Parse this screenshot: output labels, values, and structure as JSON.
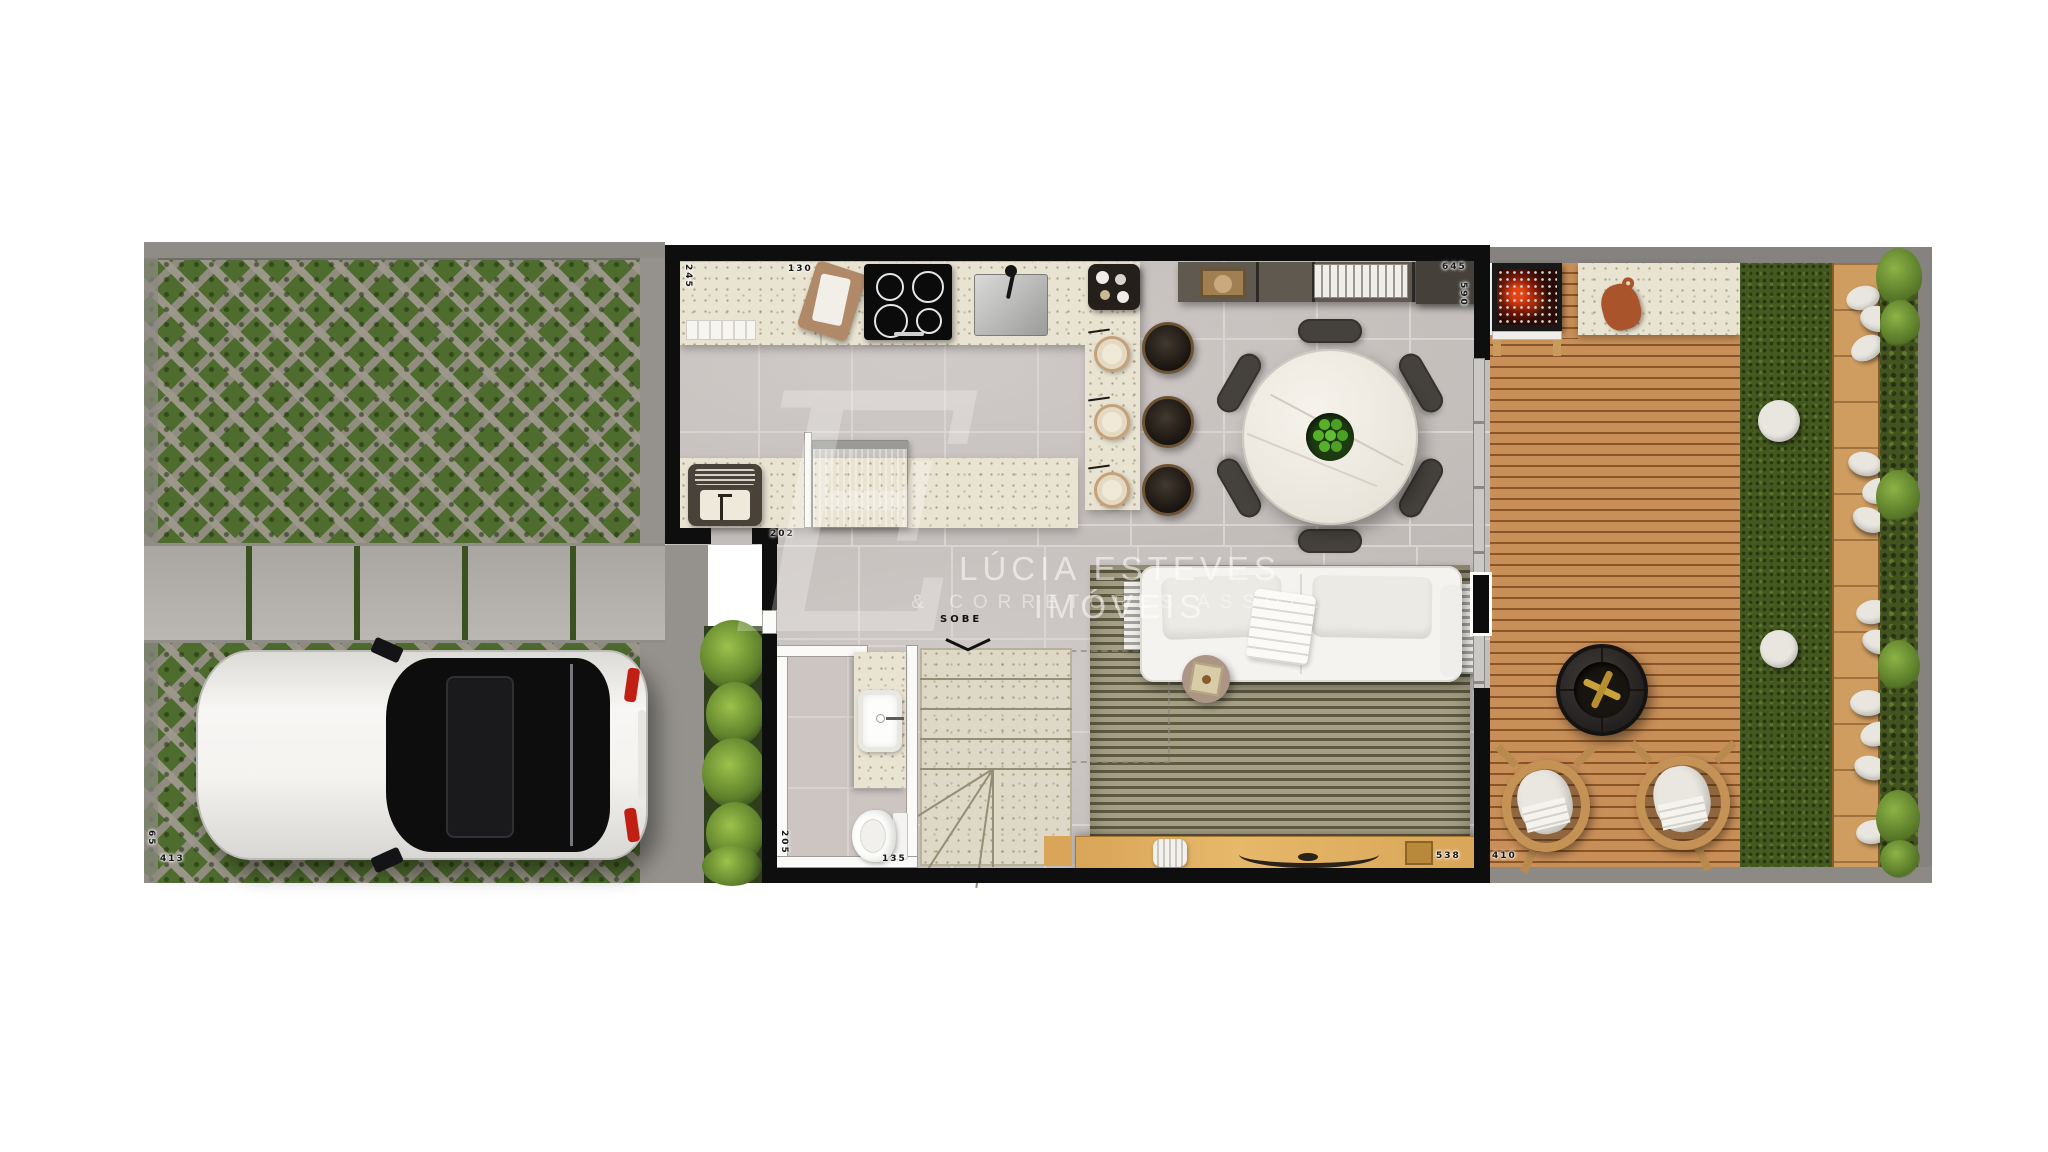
{
  "watermark": {
    "monogram": "E",
    "line1": "LÚCIA ESTEVES IMÓVEIS",
    "line2": "& CORRETORES ASSOC."
  },
  "stairs": {
    "direction_label": "SOBE"
  },
  "dimensions": {
    "counter_depth": "245",
    "counter_left_segment": "130",
    "sideboard_run": "645",
    "dining_height": "590",
    "service_opening": "202",
    "bathroom_depth": "205",
    "bathroom_width": "135",
    "living_width": "538",
    "deck_width": "410",
    "driveway_length": "413",
    "driveway_edge": "65"
  },
  "colors": {
    "wall": "#0e0e0e",
    "floor_tile": "#c9c3c0",
    "counter_granite": "#e9e3d2",
    "deck_wood": "#c08350",
    "console_wood": "#d9a558",
    "lawn_green": "#44591f",
    "paver_green": "#4e6c2e",
    "rug_olive": "#8d8668",
    "ember_red": "#e33a12",
    "taillight_red": "#c21f14",
    "watermark_white": "rgba(255,255,255,0.55)"
  }
}
